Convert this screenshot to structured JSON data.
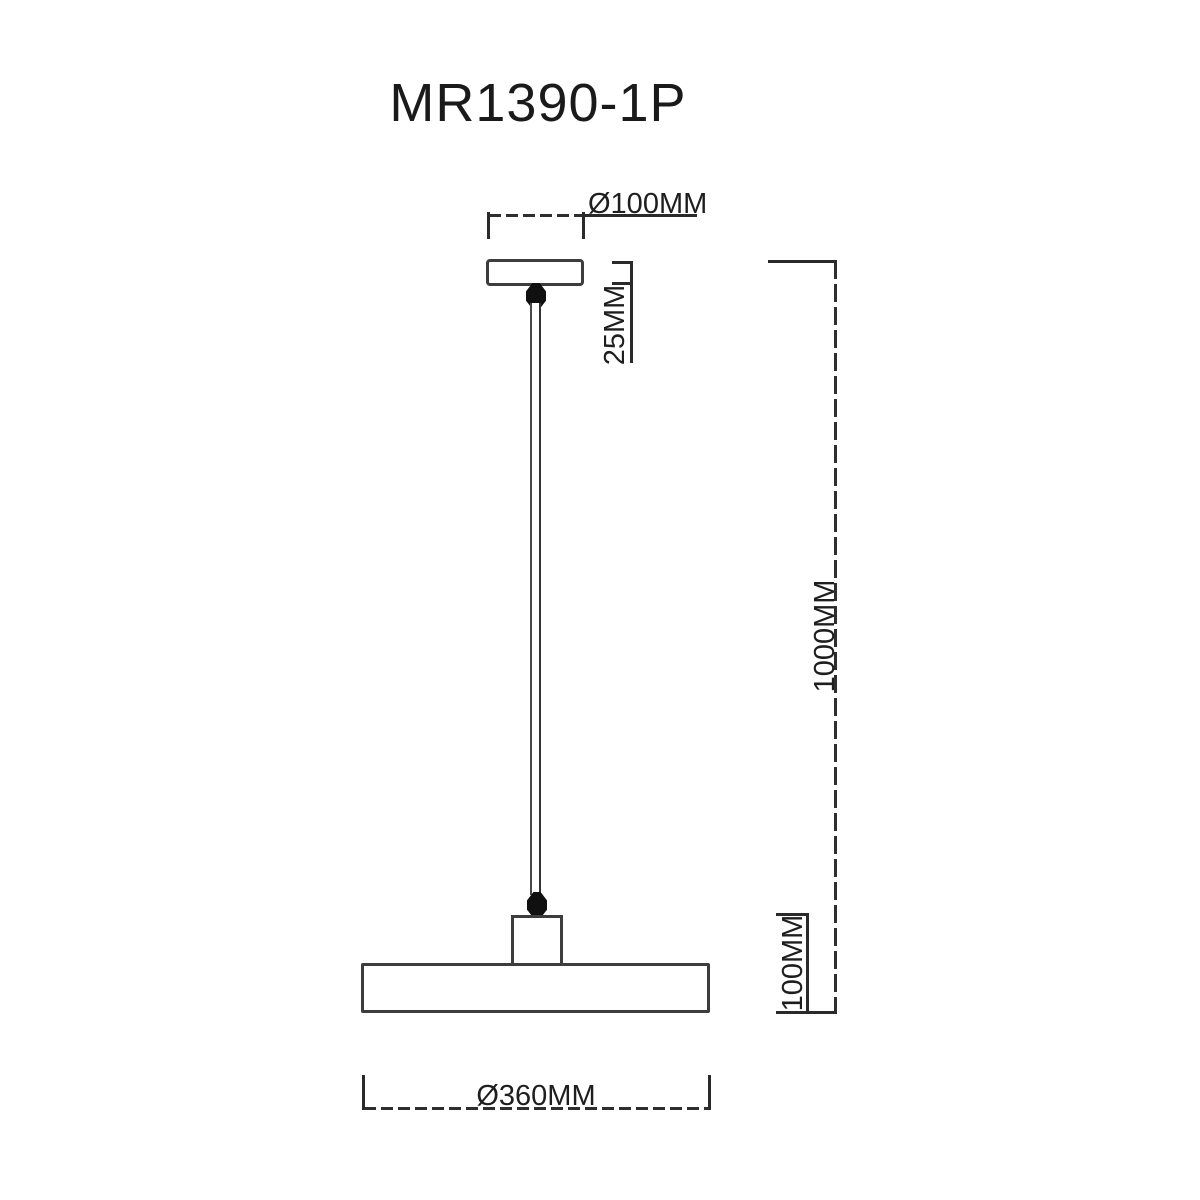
{
  "diagram": {
    "title": "MR1390-1P",
    "dimensions": {
      "canopy_diameter": "Ø100MM",
      "canopy_height": "25MM",
      "suspension_drop": "1000MM",
      "shade_height": "100MM",
      "shade_diameter": "Ø360MM"
    },
    "colors": {
      "background": "#ffffff",
      "outline": "#3d3d3d",
      "dimension_line": "#2a2a2a",
      "text": "#1e1e1e",
      "cord_grip": "#101010"
    }
  }
}
